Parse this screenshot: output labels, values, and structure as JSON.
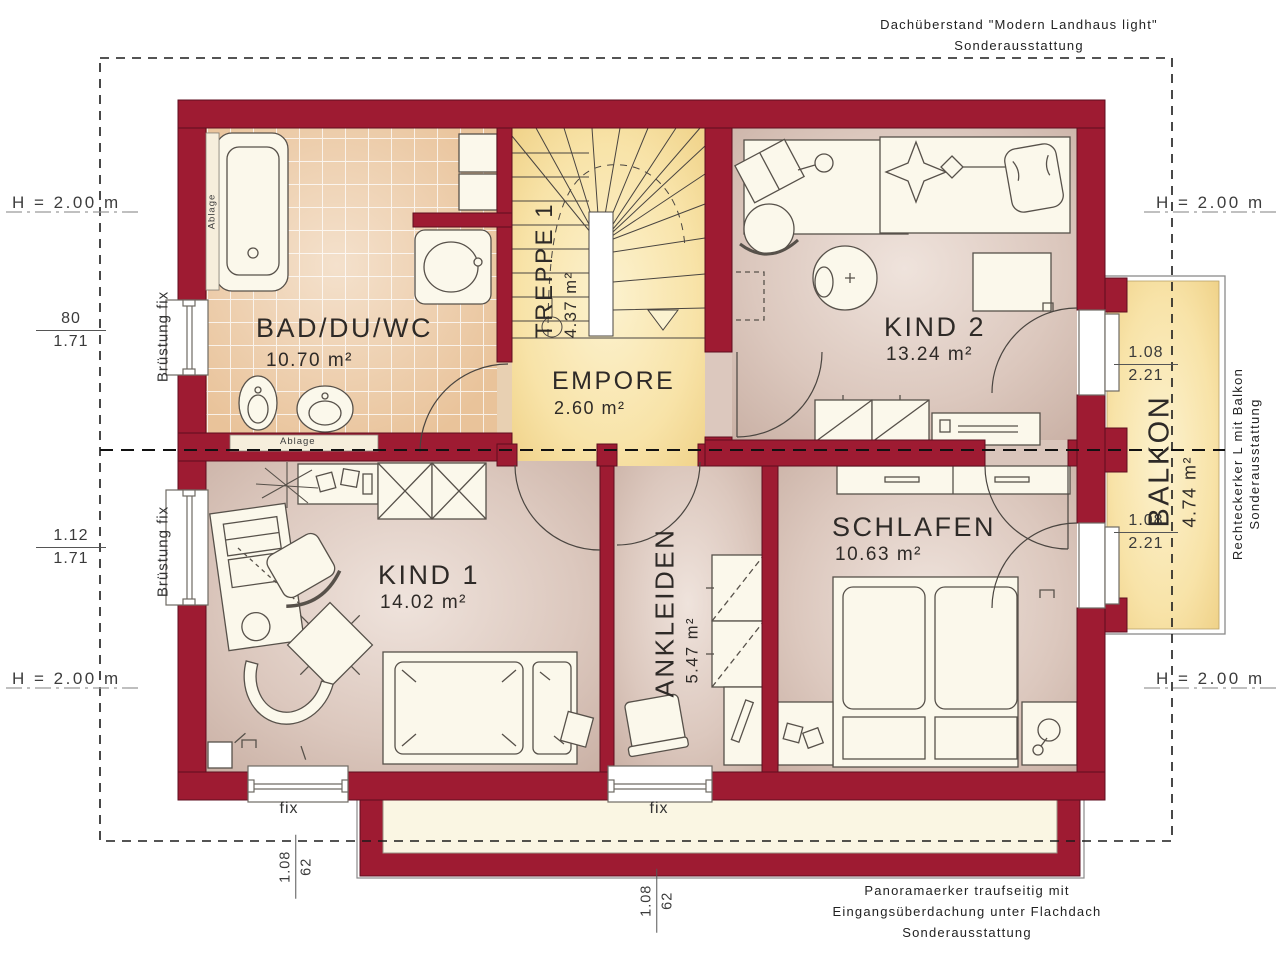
{
  "meta": {
    "width": 1280,
    "height": 960,
    "drawing_type": "floor plan upper storey"
  },
  "colors": {
    "wall_red": "#9e1b32",
    "tile_floor": "#e9c39a",
    "room_floor": "#d8c3b8",
    "stair_floor": "#f8e3a8",
    "balcony_floor": "#f6dd9d",
    "bay_roof": "#faf6e3",
    "dashed_line": "#1b1b1b"
  },
  "annotations": {
    "roof_note_line1": "Dachüberstand \"Modern Landhaus light\"",
    "roof_note_line2": "Sonderausstattung",
    "bay_note_line1": "Panoramaerker traufseitig mit",
    "bay_note_line2": "Eingangsüberdachung unter Flachdach",
    "bay_note_line3": "Sonderausstattung",
    "balcony_note_line1": "Rechteckerker L mit Balkon",
    "balcony_note_line2": "Sonderausstattung",
    "height_marker": "H = 2.00 m",
    "parapet_label": "Brüstung fix",
    "fix_label": "fix",
    "shelf_label": "Ablage"
  },
  "rooms": {
    "bad": {
      "name": "BAD/DU/WC",
      "area": "10.70 m²"
    },
    "treppe": {
      "name": "TREPPE 1",
      "area": "4.37 m²"
    },
    "empore": {
      "name": "EMPORE",
      "area": "2.60 m²"
    },
    "kind2": {
      "name": "KIND 2",
      "area": "13.24 m²"
    },
    "kind1": {
      "name": "KIND 1",
      "area": "14.02 m²"
    },
    "ankleiden": {
      "name": "ANKLEIDEN",
      "area": "5.47 m²"
    },
    "schlafen": {
      "name": "SCHLAFEN",
      "area": "10.63 m²"
    },
    "balkon": {
      "name": "BALKON",
      "area": "4.74 m²"
    }
  },
  "dimensions": {
    "window_bad": {
      "num": "80",
      "den": "1.71"
    },
    "window_kind1": {
      "num": "1.12",
      "den": "1.71"
    },
    "balcony_door_top": {
      "num": "1.08",
      "den": "2.21"
    },
    "balcony_door_bottom": {
      "num": "1.08",
      "den": "2.21"
    },
    "window_bottom_left": {
      "num": "1.08",
      "den": "62"
    },
    "window_bottom_mid": {
      "num": "1.08",
      "den": "62"
    }
  }
}
